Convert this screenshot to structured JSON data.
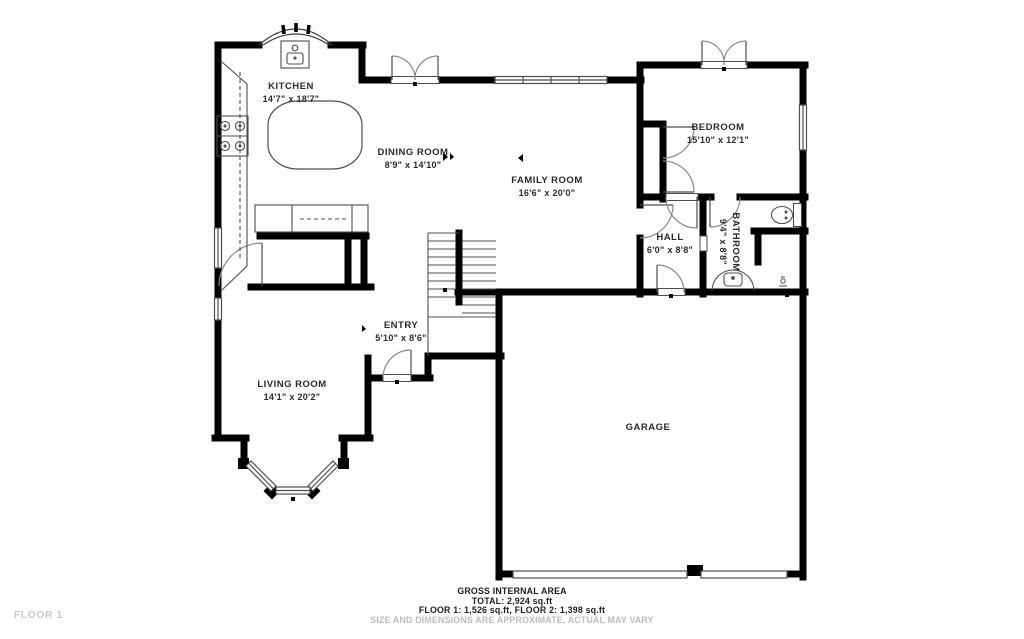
{
  "title": "Floor plan - Floor 1",
  "floor_label": "FLOOR 1",
  "rooms": [
    {
      "id": "kitchen",
      "name": "KITCHEN",
      "dims": "14'7\" x 18'7\""
    },
    {
      "id": "dining-room",
      "name": "DINING ROOM",
      "dims": "8'9\" x 14'10\""
    },
    {
      "id": "family-room",
      "name": "FAMILY ROOM",
      "dims": "16'6\" x 20'0\""
    },
    {
      "id": "bedroom",
      "name": "BEDROOM",
      "dims": "15'10\" x 12'1\""
    },
    {
      "id": "hall",
      "name": "HALL",
      "dims": "6'0\" x 8'8\""
    },
    {
      "id": "bathroom",
      "name": "BATHROOM",
      "dims": "9'4\" x 8'8\""
    },
    {
      "id": "entry",
      "name": "ENTRY",
      "dims": "5'10\" x 8'6\""
    },
    {
      "id": "living-room",
      "name": "LIVING ROOM",
      "dims": "14'1\" x 20'2\""
    },
    {
      "id": "garage",
      "name": "GARAGE",
      "dims": ""
    }
  ],
  "footer": {
    "line1": "GROSS INTERNAL AREA",
    "line2": "TOTAL: 2,924 sq.ft",
    "line3": "FLOOR 1: 1,526 sq.ft, FLOOR 2: 1,398 sq.ft",
    "line4": "SIZE AND DIMENSIONS ARE APPROXIMATE, ACTUAL MAY VARY"
  },
  "colors": {
    "wall": "#000000",
    "thin_line": "#4d4d4d",
    "door_arc": "#8a8a8a",
    "label": "#2b2b2b",
    "muted_text": "#bcbcbc"
  }
}
